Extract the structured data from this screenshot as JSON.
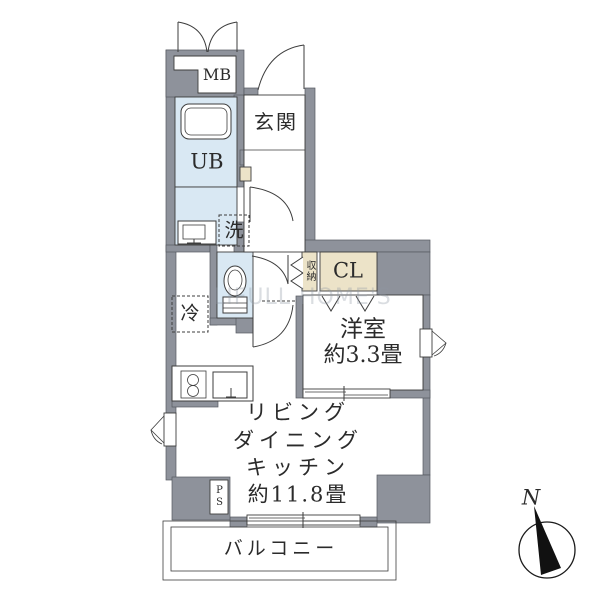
{
  "floorplan": {
    "labels": {
      "mb": "MB",
      "ub": "UB",
      "genkan": "玄関",
      "wash": "洗",
      "storage": "収納",
      "closet": "CL",
      "fridge": "冷",
      "western_room": "洋室",
      "western_room_size": "約3.3畳",
      "ldk_line1": "リビング",
      "ldk_line2": "ダイニング",
      "ldk_line3": "キッチン",
      "ldk_size": "約11.8畳",
      "balcony": "バルコニー",
      "pipe_space": "PS",
      "compass_north": "N"
    },
    "watermark": "LIFULL HOME'S",
    "colors": {
      "wall_gray": "#8e929b",
      "wet_area_blue": "#d9e8f3",
      "closet_beige": "#ece3c8",
      "outline": "#3d3d3d"
    }
  }
}
